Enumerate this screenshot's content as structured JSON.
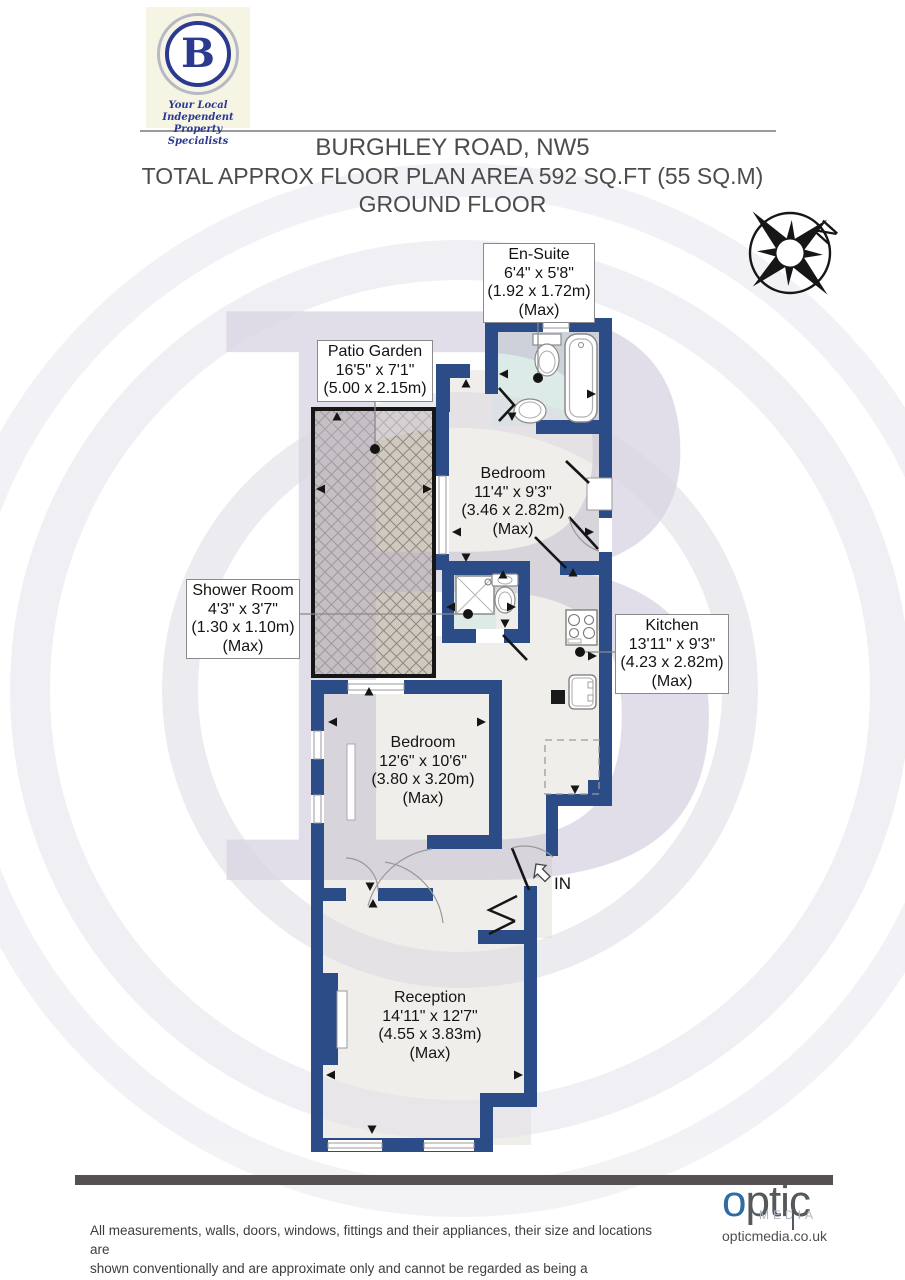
{
  "header": {
    "logo": {
      "letter": "B",
      "tagline_line1": "Your Local Independent",
      "tagline_line2": "Property Specialists"
    },
    "title": "BURGHLEY ROAD, NW5",
    "subtitle": "TOTAL APPROX FLOOR PLAN AREA 592 SQ.FT (55 SQ.M)",
    "floor_label": "GROUND FLOOR",
    "compass_north": "N"
  },
  "plan": {
    "rooms": {
      "ensuite": {
        "name": "En-Suite",
        "dims": "6'4\" x 5'8\"",
        "metric": "(1.92 x 1.72m)",
        "max": "(Max)"
      },
      "patio": {
        "name": "Patio Garden",
        "dims": "16'5\" x 7'1\"",
        "metric": "(5.00 x 2.15m)"
      },
      "bedroom1": {
        "name": "Bedroom",
        "dims": "11'4\" x 9'3\"",
        "metric": "(3.46 x 2.82m)",
        "max": "(Max)"
      },
      "shower": {
        "name": "Shower Room",
        "dims": "4'3\" x 3'7\"",
        "metric": "(1.30 x 1.10m)",
        "max": "(Max)"
      },
      "kitchen": {
        "name": "Kitchen",
        "dims": "13'11\" x 9'3\"",
        "metric": "(4.23 x 2.82m)",
        "max": "(Max)"
      },
      "bedroom2": {
        "name": "Bedroom",
        "dims": "12'6\" x 10'6\"",
        "metric": "(3.80 x 3.20m)",
        "max": "(Max)"
      },
      "reception": {
        "name": "Reception",
        "dims": "14'11\" x 12'7\"",
        "metric": "(4.55 x 3.83m)",
        "max": "(Max)"
      }
    },
    "entrance_label": "IN",
    "colors": {
      "wall": "#2b4c86",
      "room_floor": "#efeeea",
      "bathroom_floor": "#dcebe7",
      "patio_fill": "#cfc9c0",
      "watermark": "#c6c0d3",
      "logo_navy": "#2b3990"
    }
  },
  "footer": {
    "disclaimer_line1": "All measurements, walls, doors, windows, fittings and their appliances, their size and locations are",
    "disclaimer_line2": "shown conventionally and are approximate only and cannot be regarded as being a representation",
    "disclaimer_line3": "either by the seller or his agent.",
    "brand": {
      "o": "o",
      "rest": "ptic",
      "media": "MEDIA",
      "url": "opticmedia.co.uk"
    }
  }
}
